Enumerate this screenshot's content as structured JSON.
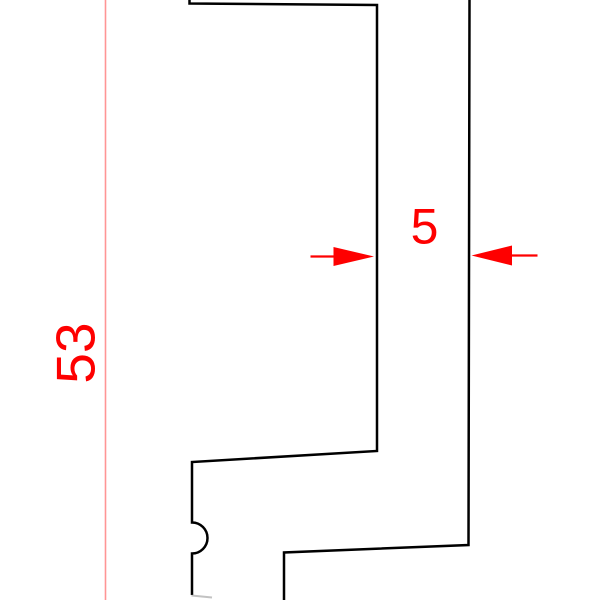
{
  "drawing": {
    "type": "technical-profile-cross-section",
    "background": "#ffffff",
    "outline_color": "#000000",
    "accent_color": "#fe0000",
    "extension_line_color": "#ff9595",
    "faint_edge_color": "#8f8f8f"
  },
  "profile": {
    "body_path": "M 189.5 0 L 189.5 3.5 L 377 5 L 377 451 L 192 462 L 192 522.5 A 15.5 15.5 0 0 1 192 553.5 L 192 595",
    "right_wall_path": "M 469.5 0 L 468.5 545 L 284 552.5 L 284 600",
    "foot_edge_path": "M 191.5 595.5 L 212 597.5"
  },
  "dimensions": {
    "height_53": {
      "label": "53",
      "extension_line_path": "M 105.5 0 L 105.5 600"
    },
    "width_5": {
      "label": "5",
      "left_arrow_tail_path": "M 310.5 256.5 L 337 256.5",
      "left_arrow_head_points": "374,256.5 333.5,247 333.5,266",
      "right_arrow_tail_path": "M 512 255.5 L 537.5 255.5",
      "right_arrow_head_points": "471.5,255.5 512,245.5 512,265.5"
    }
  }
}
